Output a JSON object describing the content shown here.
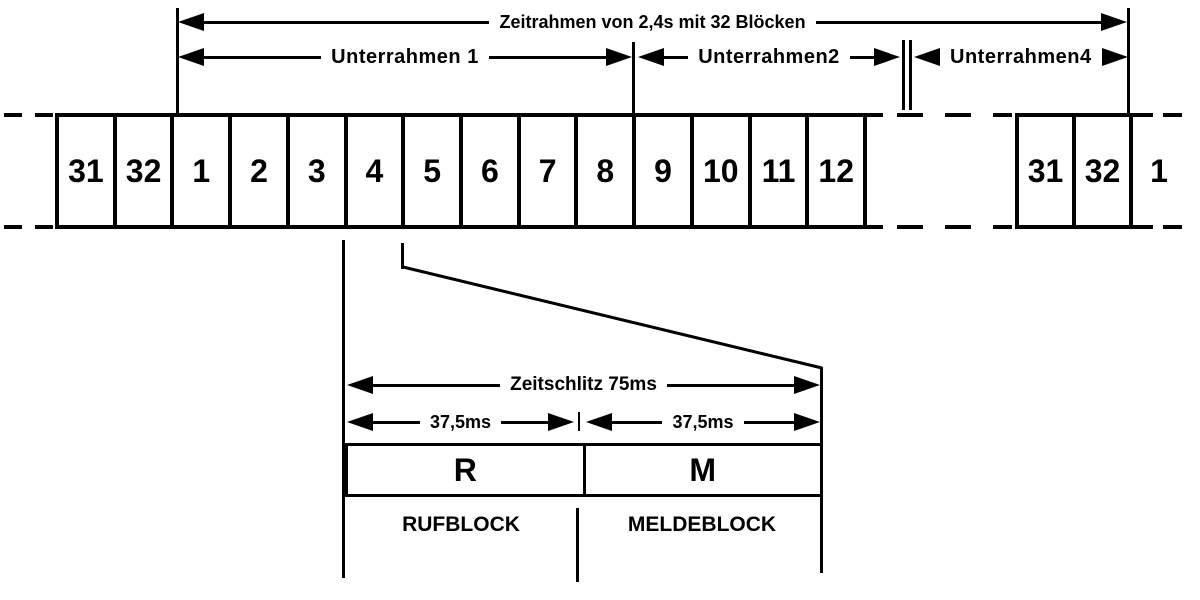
{
  "diagram": {
    "frame_arrow_label": "Zeitrahmen von 2,4s mit 32 Blöcken",
    "subframe_arrows": [
      {
        "label": "Unterrahmen 1"
      },
      {
        "label": "Unterrahmen2"
      },
      {
        "label": "Unterrahmen4"
      }
    ],
    "blocks": {
      "left": [
        "31",
        "32",
        "1",
        "2",
        "3",
        "4",
        "5",
        "6",
        "7",
        "8",
        "9",
        "10",
        "11",
        "12"
      ],
      "right": [
        "31",
        "32"
      ],
      "trailing": "1"
    },
    "slot_detail": {
      "slot_arrow_label": "Zeitschlitz 75ms",
      "half_labels": [
        "37,5ms",
        "37,5ms"
      ],
      "cells": [
        {
          "abbr": "R",
          "name": "RUFBLOCK"
        },
        {
          "abbr": "M",
          "name": "MELDEBLOCK"
        }
      ]
    },
    "colors": {
      "line": "#000000",
      "background": "#ffffff"
    }
  }
}
